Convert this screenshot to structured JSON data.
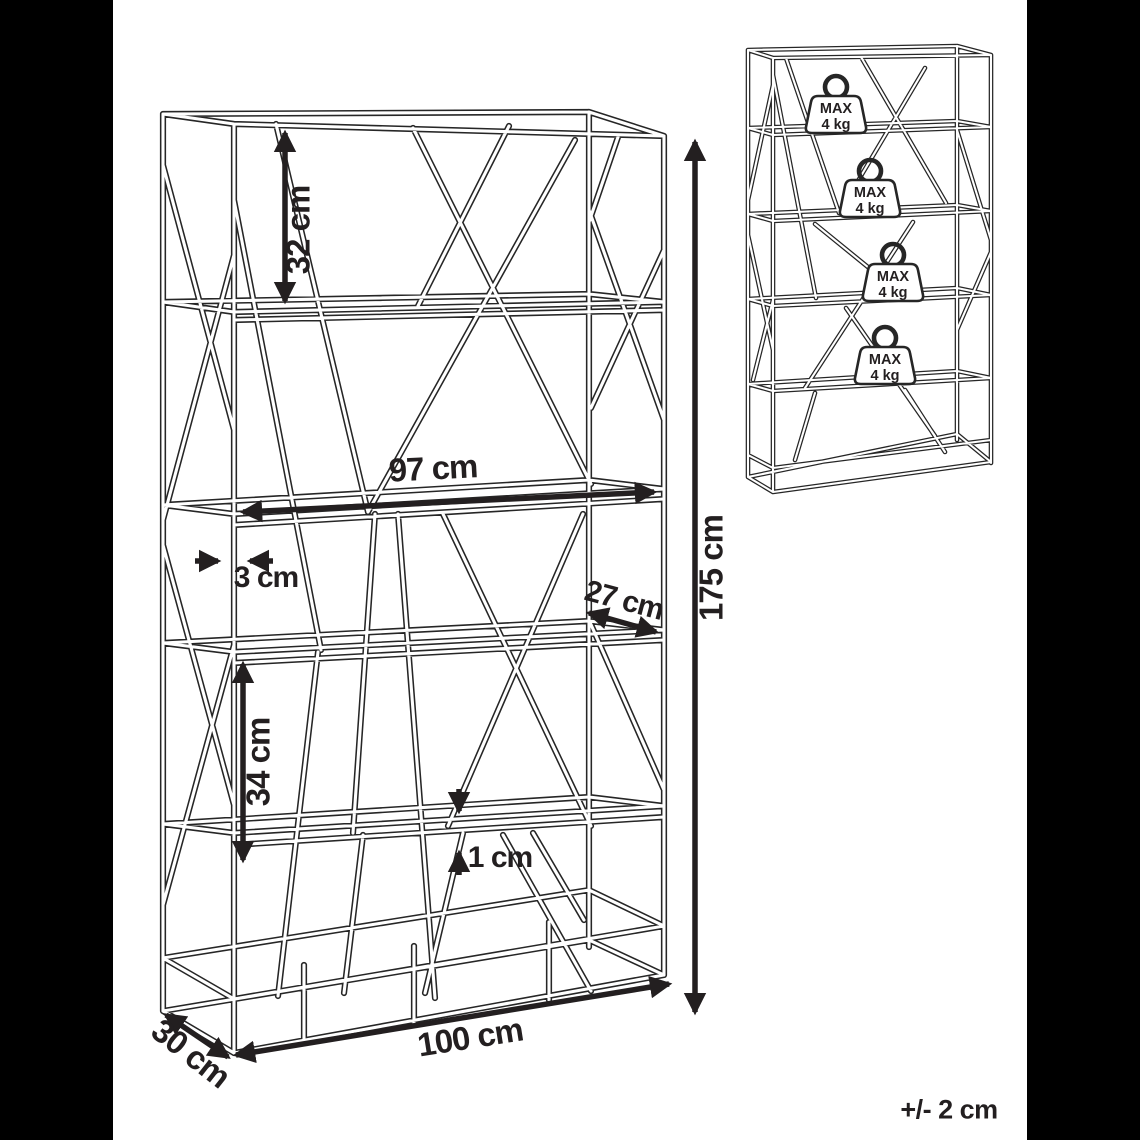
{
  "tolerance_note": "+/- 2 cm",
  "main_view": {
    "dimensions": {
      "top_section_height": "32 cm",
      "shelf_inner_width": "97 cm",
      "frame_thickness": "3 cm",
      "shelf_depth": "27 cm",
      "section_height": "34 cm",
      "shelf_thickness": "1 cm",
      "total_height": "175 cm",
      "total_width": "100 cm",
      "total_depth": "30 cm"
    }
  },
  "load_view": {
    "weights": [
      {
        "line1": "MAX",
        "line2": "4 kg"
      },
      {
        "line1": "MAX",
        "line2": "4 kg"
      },
      {
        "line1": "MAX",
        "line2": "4 kg"
      },
      {
        "line1": "MAX",
        "line2": "4 kg"
      }
    ]
  },
  "colors": {
    "viewer_background": "#000000",
    "image_background": "#ffffff",
    "line": "#262626",
    "text": "#231f20"
  }
}
